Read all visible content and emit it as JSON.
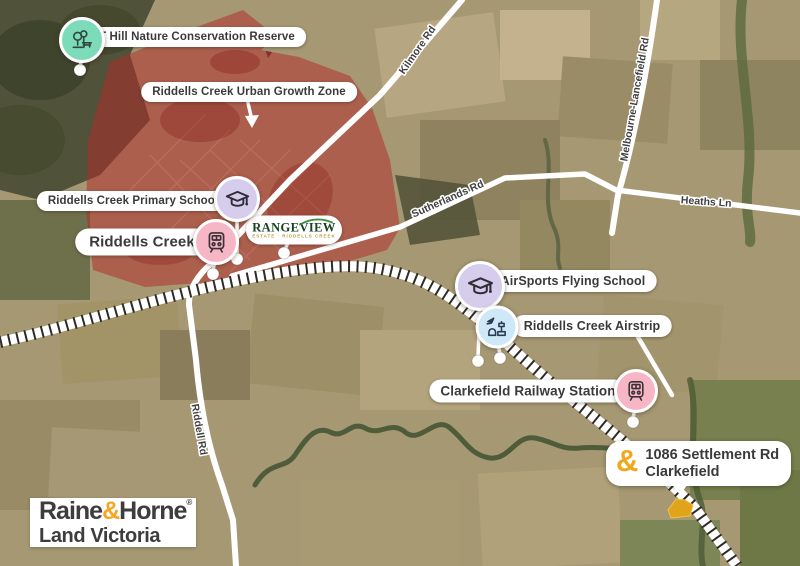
{
  "labels": {
    "reserve": "T Hill Nature Conservation Reserve",
    "growth_zone": "Riddells Creek Urban Growth Zone",
    "primary_school": "Riddells Creek Primary School",
    "town": "Riddells Creek",
    "airsports": "AirSports Flying School",
    "airstrip": "Riddells Creek Airstrip",
    "station": "Clarkefield Railway Station"
  },
  "property": {
    "amp": "&",
    "line1": "1086 Settlement Rd",
    "line2": "Clarkefield"
  },
  "rangeview": {
    "name": "RANGEVIEW",
    "sub": "ESTATE · RIDDELLS CREEK"
  },
  "roads": {
    "kilmore": "Kilmore Rd",
    "melbourne_lancefield": "Melbourne-Lancefield Rd",
    "sutherlands": "Sutherlands Rd",
    "heaths": "Heaths Ln",
    "riddell": "Riddell Rd"
  },
  "logo": {
    "raine": "Raine",
    "amp": "&",
    "horne": "Horne",
    "reg": "®",
    "sub": "Land Victoria"
  },
  "icons": {
    "reserve": "park-trees-icon",
    "school": "graduation-cap-icon",
    "train": "train-icon",
    "airport": "airport-tower-icon",
    "property": "ampersand-icon"
  },
  "colors": {
    "zone_overlay": "#b22a2a",
    "gold": "#f0a81d",
    "teal_marker": "#7cdcba",
    "lavender_marker": "#d6cdec",
    "pink_marker": "#f7b6c6",
    "blue_marker": "#cfe8f7",
    "pill_text": "#3a3a3c"
  }
}
